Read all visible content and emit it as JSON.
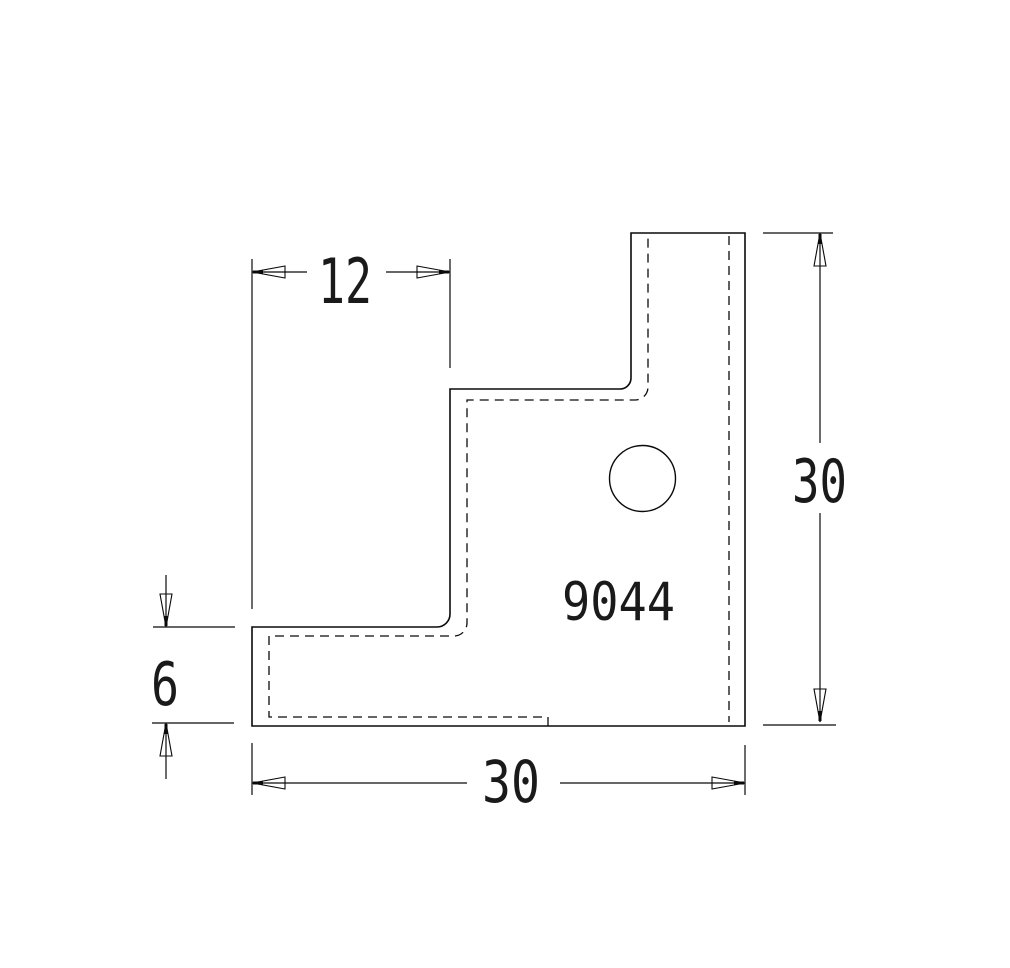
{
  "drawing": {
    "background_color": "#ffffff",
    "line_color": "#0a0a0a",
    "part_label": "9044",
    "dimensions": {
      "top_width": {
        "value": "12"
      },
      "right_height": {
        "value": "30"
      },
      "bottom_width": {
        "value": "30"
      },
      "left_flange": {
        "value": "6"
      }
    }
  }
}
